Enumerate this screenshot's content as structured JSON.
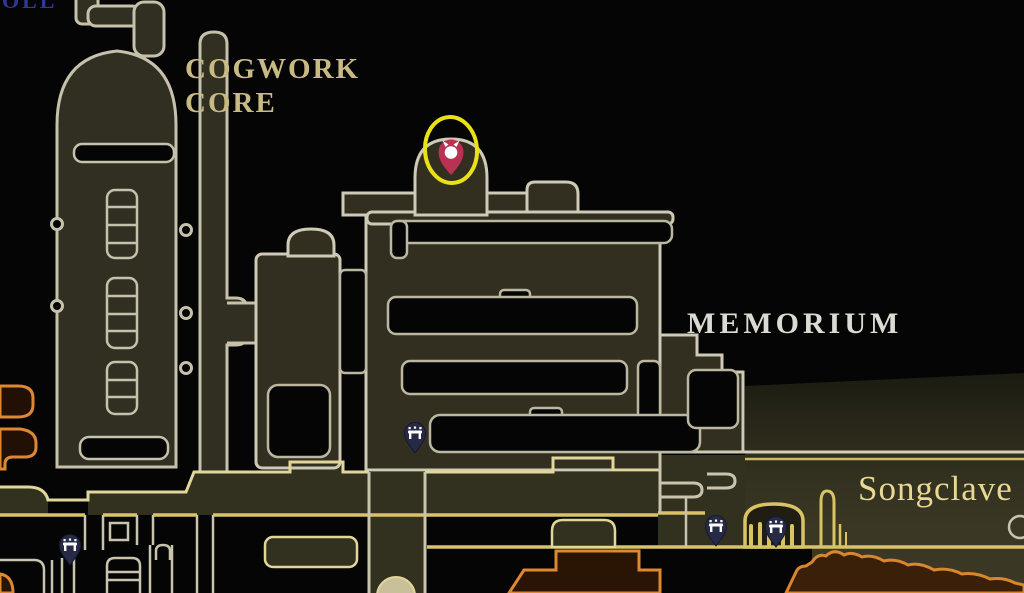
{
  "screen": {
    "description": "In-game world map screenshot with region names, an objective pin highlighted by a yellow circle, and bench (rest point) markers",
    "width": 1024,
    "height": 593
  },
  "map": {
    "region_labels": {
      "cogwork_core": {
        "line1": "COGWORK",
        "line2": "CORE"
      },
      "memorium": {
        "text": "MEMORIUM"
      },
      "songclave": {
        "text": "Songclave"
      },
      "edge_clipped_text": {
        "text": "OLL"
      }
    },
    "markers": {
      "objective_pin": {
        "icon": "location-pin-icon",
        "x": 451,
        "y": 152,
        "pin_color": "#bb3153",
        "glyph": "bug-head",
        "highlight_circle": {
          "x": 451,
          "y": 150,
          "rx": 26,
          "ry": 33,
          "color": "#e9e217"
        }
      },
      "benches": [
        {
          "icon": "bench-icon",
          "x": 415,
          "y": 433
        },
        {
          "icon": "bench-icon",
          "x": 70,
          "y": 545
        },
        {
          "icon": "bench-icon",
          "x": 716,
          "y": 526
        },
        {
          "icon": "bench-icon",
          "x": 776,
          "y": 527
        }
      ]
    },
    "colors": {
      "background": "#050505",
      "room_fill": "#322f20",
      "room_outline": "#cfcab6",
      "corridor_gold": "#d9c464",
      "corridor_pale": "#e2d79b",
      "songclave_fill": "#3a3824",
      "orange_outline": "#dd8833",
      "orange_fill": "#2a1505",
      "bench_pin": "#262a45",
      "objective_red": "#bb3153",
      "highlight_yellow": "#e9e217",
      "label_tan": "#c9ba84",
      "label_white": "#dcdbd3",
      "label_yellow": "#e9d893",
      "edge_text_blue": "#31369b"
    }
  }
}
